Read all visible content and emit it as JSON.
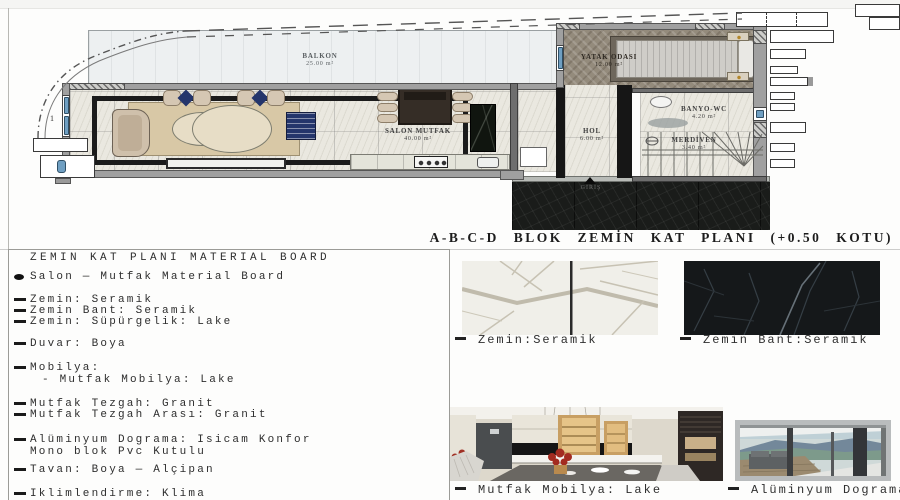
{
  "plan": {
    "title": "A-B-C-D BLOK ZEMİN KAT PLANI (+0.50 KOTU)",
    "rooms": {
      "balkon": {
        "name": "BALKON",
        "area": "25.00 m²"
      },
      "salon": {
        "name": "SALON MUTFAK",
        "area": "40.00 m²"
      },
      "yatak": {
        "name": "YATAK ODASI",
        "area": "12.00 m²"
      },
      "hol": {
        "name": "HOL",
        "area": "6.00 m²"
      },
      "banyo": {
        "name": "BANYO-WC",
        "area": "4.20 m²"
      },
      "merdiven": {
        "name": "MERDİVEN",
        "area": "3.40 m²"
      }
    },
    "entrance_label": "GİRİŞ",
    "section_marker": "1"
  },
  "board": {
    "heading": "ZEMIN KAT PLANI MATERIAL BOARD",
    "bullet_line": "Salon — Mutfak Material Board",
    "lines": [
      {
        "text": "Zemin: Seramik"
      },
      {
        "text": "Zemin Bant: Seramik"
      },
      {
        "text": "Zemin: Süpürgelik: Lake"
      },
      {
        "text": "Duvar: Boya"
      },
      {
        "text": "Mobilya:"
      },
      {
        "text": "- Mutfak Mobilya: Lake"
      },
      {
        "text": "Mutfak Tezgah: Granit"
      },
      {
        "text": "Mutfak Tezgah Arası: Granit"
      },
      {
        "text": "Alüminyum Dograma: Isicam Konfor"
      },
      {
        "text": "Mono blok Pvc Kutulu"
      },
      {
        "text": "Tavan: Boya — Alçipan"
      },
      {
        "text": "Iklimlendirme: Klima"
      }
    ]
  },
  "swatches": {
    "zemin": {
      "caption": "Zemin:Seramik"
    },
    "zemin_bant": {
      "caption": "Zemin Bant:Seramik"
    },
    "mutfak": {
      "caption": "Mutfak Mobilya: Lake"
    },
    "aluminyum": {
      "caption": "Alüminyum Dograma"
    }
  },
  "colors": {
    "wall_gray": "#a0a0a0",
    "marble_floor": "#eae8e0",
    "dark_marble": "#1a1c1a",
    "wood_floor": "#948b7c",
    "navy_accent": "#24356b",
    "rug_beige": "#d8c8a6"
  }
}
